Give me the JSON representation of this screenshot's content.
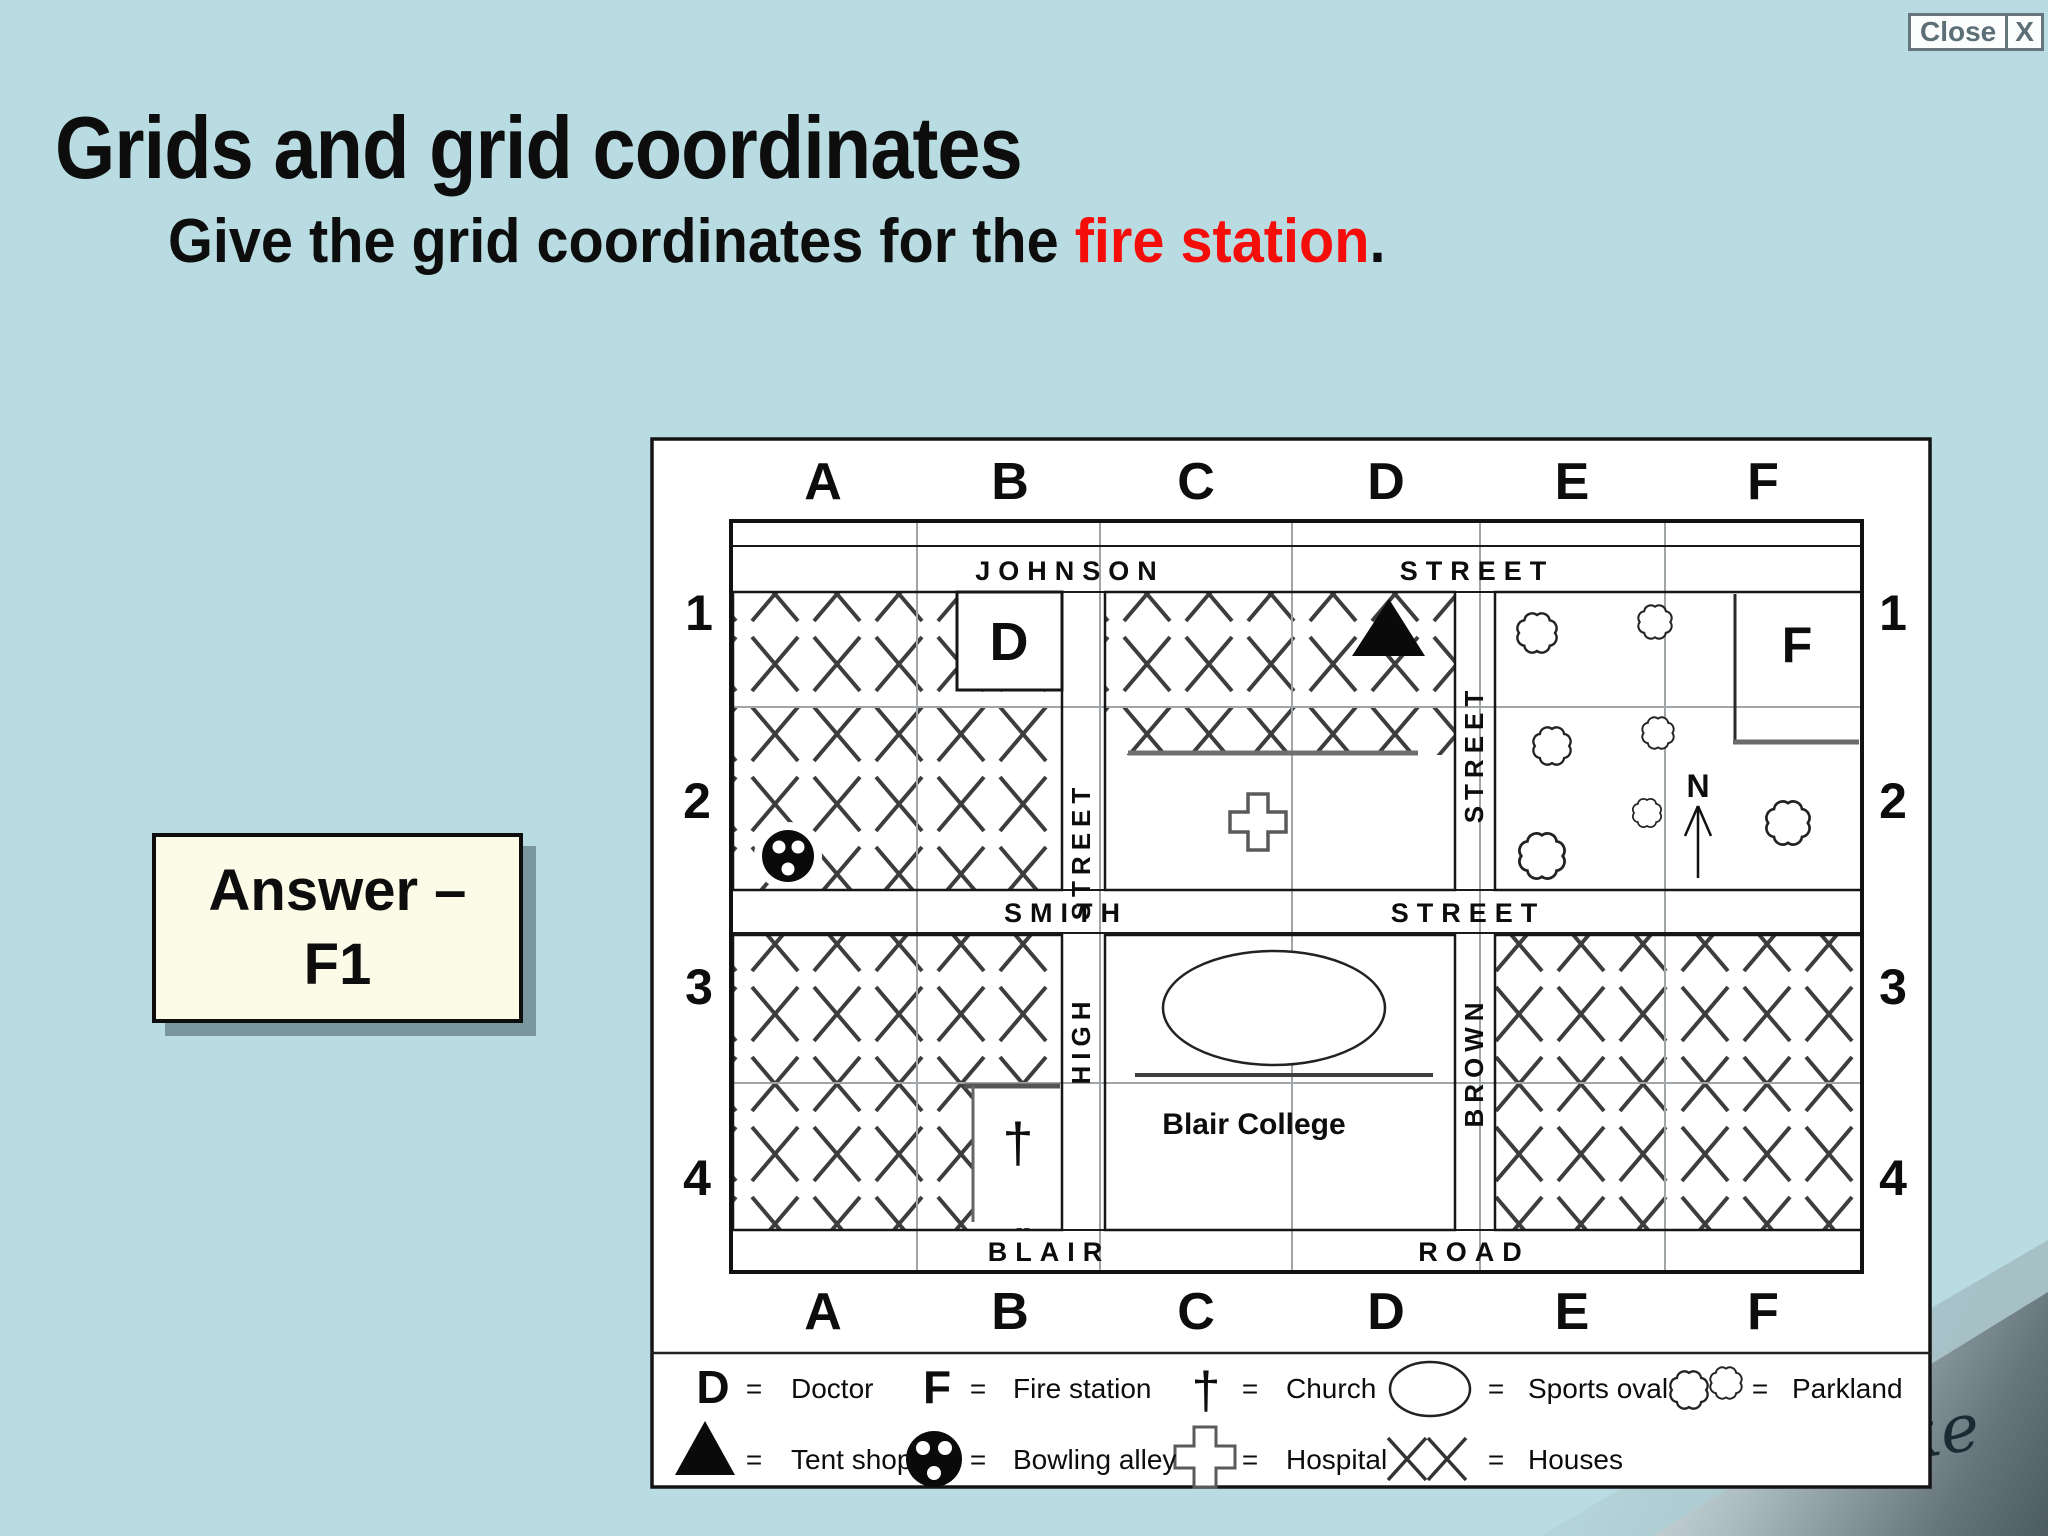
{
  "window": {
    "close_label": "Close",
    "close_x": "X"
  },
  "slide": {
    "title": "Grids and grid coordinates",
    "question_prefix": "Give the grid coordinates for the ",
    "question_highlight": "fire station",
    "question_suffix": ".",
    "answer_line1": "Answer –",
    "answer_line2": "F1",
    "signature": "Blake"
  },
  "map": {
    "columns": [
      "A",
      "B",
      "C",
      "D",
      "E",
      "F"
    ],
    "rows": [
      "1",
      "2",
      "3",
      "4"
    ],
    "streets": {
      "johnson_name": "JOHNSON",
      "johnson_type": "STREET",
      "smith_name": "SMITH",
      "smith_type": "STREET",
      "blair_name": "BLAIR",
      "blair_type": "ROAD",
      "high_name": "HIGH",
      "high_type": "STREET",
      "brown_name": "BROWN",
      "brown_type": "STREET"
    },
    "features": {
      "doctor_label": "D",
      "fire_station_label": "F",
      "church_symbol": "†",
      "north_label": "N",
      "college_label": "Blair College"
    }
  },
  "legend": {
    "equals": "=",
    "symbols": {
      "doctor": "D",
      "fire_station": "F",
      "church": "†"
    },
    "doctor": "Doctor",
    "fire_station": "Fire station",
    "church": "Church",
    "sports_oval": "Sports oval",
    "parkland": "Parkland",
    "tent_shop": "Tent shop",
    "bowling_alley": "Bowling alley",
    "hospital": "Hospital",
    "houses": "Houses"
  },
  "colors": {
    "background": "#b9dce2",
    "highlight": "#f50d0a",
    "answer_bg": "#fcfbe7",
    "map_bg": "#ffffff",
    "ink": "#0d0d0d"
  }
}
